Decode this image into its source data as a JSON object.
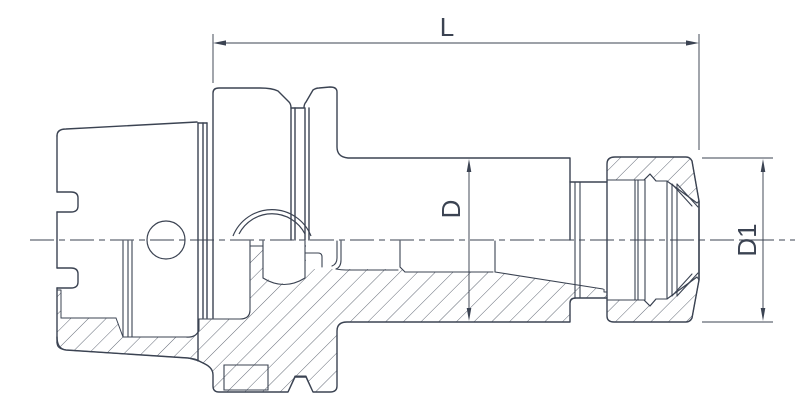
{
  "drawing": {
    "description": "Sectional technical drawing of an HSK collet chuck tool holder",
    "labels": {
      "overall_length": "L",
      "body_diameter": "D",
      "nut_diameter": "D1"
    },
    "colors": {
      "line": "#3b4352",
      "background": "#ffffff"
    }
  }
}
